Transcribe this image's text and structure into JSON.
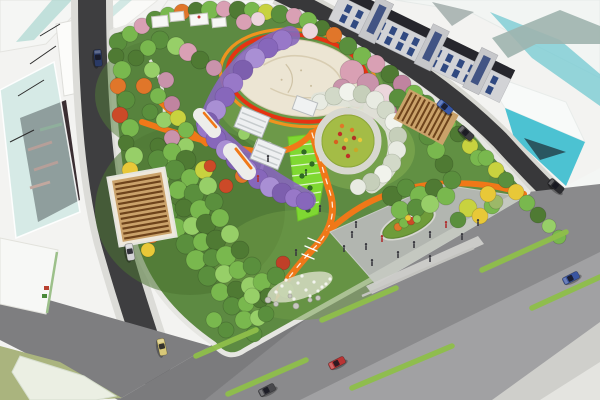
{
  "description": "Aerial perspective rendering of an urban pocket-park masterplan with surrounding streets and schematic buildings",
  "palette": {
    "bg": "#f3f3f1",
    "road_dark": "#3e3e40",
    "road_top": "#38383a",
    "sidewalk": "#dcdcd8",
    "boulevard": "#8a8a8c",
    "cross_road": "#7e7e80",
    "park_green": "#5d8a42",
    "lawn_bright": "#7fd832",
    "path_orange": "#f07818",
    "ring_red": "#e63312",
    "ring_orange": "#f7941d",
    "plaza_cream": "#ece5d3",
    "plaza_gray": "#b2b6b0",
    "wisteria": "#9878c8",
    "glass_teal": "#4cc2d2",
    "glass_white": "#f8faf9",
    "window_blue": "#1e3a78",
    "pergola_wood": "#caa26a",
    "pergola_slat": "#6e441c",
    "olive_plot": "#aab47e",
    "stripe_green": "#8fbf4a",
    "curb_white": "#e6e6e2"
  },
  "scene": {
    "trees": [
      [
        118,
        42,
        9,
        "#5a8f3d"
      ],
      [
        130,
        34,
        8,
        "#79b84e"
      ],
      [
        142,
        26,
        8,
        "#d9a0b4"
      ],
      [
        155,
        20,
        9,
        "#5a8f3d"
      ],
      [
        168,
        15,
        8,
        "#79b84e"
      ],
      [
        182,
        12,
        8,
        "#e0762a"
      ],
      [
        196,
        10,
        8,
        "#4f7a33"
      ],
      [
        210,
        10,
        9,
        "#79b84e"
      ],
      [
        224,
        9,
        8,
        "#d9a0b4"
      ],
      [
        238,
        10,
        9,
        "#4f7a33"
      ],
      [
        252,
        10,
        8,
        "#79b84e"
      ],
      [
        266,
        12,
        8,
        "#c8d23f"
      ],
      [
        280,
        14,
        9,
        "#5a8f3d"
      ],
      [
        294,
        16,
        8,
        "#d9a0b4"
      ],
      [
        308,
        21,
        9,
        "#79b84e"
      ],
      [
        322,
        28,
        8,
        "#4f7a33"
      ],
      [
        334,
        35,
        8,
        "#e0762a"
      ],
      [
        310,
        31,
        8,
        "#ecd6dc"
      ],
      [
        244,
        22,
        8,
        "#d9a0b4"
      ],
      [
        258,
        19,
        7,
        "#ecd6dc"
      ],
      [
        348,
        46,
        9,
        "#5a8f3d"
      ],
      [
        362,
        56,
        9,
        "#79b84e"
      ],
      [
        376,
        64,
        9,
        "#d9a0b4"
      ],
      [
        390,
        74,
        9,
        "#4f7a33"
      ],
      [
        402,
        84,
        9,
        "#c084a0"
      ],
      [
        414,
        94,
        9,
        "#79b84e"
      ],
      [
        426,
        104,
        9,
        "#5a8f3d"
      ],
      [
        438,
        114,
        8,
        "#97cf68"
      ],
      [
        448,
        124,
        8,
        "#79b84e"
      ],
      [
        458,
        134,
        8,
        "#4f7a33"
      ],
      [
        470,
        146,
        8,
        "#c8d23f"
      ],
      [
        478,
        158,
        8,
        "#79b84e"
      ],
      [
        352,
        72,
        12,
        "#d9a0b4"
      ],
      [
        368,
        84,
        11,
        "#c993ab"
      ],
      [
        384,
        95,
        11,
        "#ecd6dc"
      ],
      [
        357,
        97,
        10,
        "#c084a0"
      ],
      [
        373,
        109,
        10,
        "#d9a0b4"
      ],
      [
        342,
        88,
        9,
        "#c993ab"
      ],
      [
        388,
        112,
        9,
        "#c084a0"
      ],
      [
        160,
        40,
        9,
        "#5a8f3d"
      ],
      [
        148,
        48,
        8,
        "#79b84e"
      ],
      [
        136,
        58,
        8,
        "#4f7a33"
      ],
      [
        152,
        70,
        8,
        "#97cf68"
      ],
      [
        166,
        80,
        8,
        "#c993ab"
      ],
      [
        144,
        86,
        8,
        "#e0762a"
      ],
      [
        158,
        96,
        8,
        "#79b84e"
      ],
      [
        172,
        104,
        8,
        "#c084a0"
      ],
      [
        150,
        112,
        8,
        "#5a8f3d"
      ],
      [
        164,
        120,
        8,
        "#97cf68"
      ],
      [
        178,
        118,
        8,
        "#c8d23f"
      ],
      [
        186,
        130,
        8,
        "#79b84e"
      ],
      [
        172,
        138,
        8,
        "#c993ab"
      ],
      [
        158,
        146,
        8,
        "#4f7a33"
      ],
      [
        186,
        146,
        8,
        "#97cf68"
      ],
      [
        174,
        158,
        9,
        "#79b84e"
      ],
      [
        176,
        46,
        9,
        "#97cf68"
      ],
      [
        188,
        52,
        9,
        "#d9a0b4"
      ],
      [
        200,
        60,
        9,
        "#4f7a33"
      ],
      [
        214,
        68,
        8,
        "#c993ab"
      ],
      [
        116,
        56,
        8,
        "#4f7a33"
      ],
      [
        122,
        70,
        9,
        "#79b84e"
      ],
      [
        118,
        86,
        8,
        "#e0762a"
      ],
      [
        126,
        100,
        9,
        "#5a8f3d"
      ],
      [
        120,
        115,
        8,
        "#cc4a28"
      ],
      [
        130,
        128,
        9,
        "#79b84e"
      ],
      [
        126,
        143,
        8,
        "#4f7a33"
      ],
      [
        134,
        156,
        9,
        "#97cf68"
      ],
      [
        130,
        170,
        8,
        "#e8c838"
      ],
      [
        138,
        184,
        8,
        "#5a8f3d"
      ],
      [
        134,
        198,
        8,
        "#79b84e"
      ],
      [
        142,
        212,
        8,
        "#4f7a33"
      ],
      [
        146,
        226,
        8,
        "#97cf68"
      ],
      [
        158,
        160,
        10,
        "#5a8f3d"
      ],
      [
        172,
        152,
        9,
        "#79b84e"
      ],
      [
        186,
        160,
        10,
        "#4f7a33"
      ],
      [
        160,
        178,
        9,
        "#97cf68"
      ],
      [
        175,
        170,
        10,
        "#5a8f3d"
      ],
      [
        190,
        178,
        9,
        "#79b84e"
      ],
      [
        204,
        170,
        9,
        "#c8d23f"
      ],
      [
        162,
        196,
        10,
        "#4f7a33"
      ],
      [
        178,
        190,
        9,
        "#79b84e"
      ],
      [
        194,
        194,
        10,
        "#5a8f3d"
      ],
      [
        208,
        186,
        9,
        "#97cf68"
      ],
      [
        168,
        212,
        10,
        "#5a8f3d"
      ],
      [
        184,
        208,
        9,
        "#4f7a33"
      ],
      [
        200,
        210,
        10,
        "#79b84e"
      ],
      [
        214,
        202,
        9,
        "#5a8f3d"
      ],
      [
        176,
        228,
        10,
        "#79b84e"
      ],
      [
        192,
        226,
        9,
        "#97cf68"
      ],
      [
        206,
        224,
        10,
        "#4f7a33"
      ],
      [
        220,
        218,
        9,
        "#79b84e"
      ],
      [
        186,
        244,
        10,
        "#5a8f3d"
      ],
      [
        202,
        242,
        9,
        "#79b84e"
      ],
      [
        216,
        240,
        10,
        "#4f7a33"
      ],
      [
        230,
        234,
        9,
        "#97cf68"
      ],
      [
        196,
        260,
        10,
        "#79b84e"
      ],
      [
        212,
        258,
        9,
        "#5a8f3d"
      ],
      [
        226,
        256,
        10,
        "#79b84e"
      ],
      [
        240,
        250,
        9,
        "#4f7a33"
      ],
      [
        208,
        276,
        10,
        "#5a8f3d"
      ],
      [
        224,
        274,
        9,
        "#97cf68"
      ],
      [
        238,
        270,
        9,
        "#79b84e"
      ],
      [
        252,
        266,
        9,
        "#5a8f3d"
      ],
      [
        220,
        292,
        9,
        "#79b84e"
      ],
      [
        236,
        290,
        9,
        "#4f7a33"
      ],
      [
        250,
        286,
        9,
        "#97cf68"
      ],
      [
        232,
        306,
        9,
        "#5a8f3d"
      ],
      [
        246,
        304,
        8,
        "#79b84e"
      ],
      [
        260,
        300,
        8,
        "#4f7a33"
      ],
      [
        244,
        320,
        9,
        "#79b84e"
      ],
      [
        258,
        318,
        8,
        "#97cf68"
      ],
      [
        254,
        334,
        8,
        "#5a8f3d"
      ],
      [
        226,
        330,
        8,
        "#5a8f3d"
      ],
      [
        214,
        320,
        8,
        "#79b84e"
      ],
      [
        152,
        236,
        7,
        "#e0762a"
      ],
      [
        226,
        186,
        7,
        "#cc4a28"
      ],
      [
        148,
        250,
        7,
        "#e8c838"
      ],
      [
        242,
        176,
        7,
        "#e0762a"
      ],
      [
        210,
        166,
        6,
        "#cc4a28"
      ],
      [
        283,
        263,
        7,
        "#c04028"
      ],
      [
        262,
        282,
        9,
        "#79b84e"
      ],
      [
        276,
        276,
        9,
        "#5a8f3d"
      ],
      [
        252,
        296,
        8,
        "#97cf68"
      ],
      [
        268,
        296,
        8,
        "#4f7a33"
      ],
      [
        286,
        290,
        8,
        "#79b84e"
      ],
      [
        266,
        314,
        8,
        "#5a8f3d"
      ],
      [
        468,
        208,
        9,
        "#c8d23f"
      ],
      [
        480,
        216,
        8,
        "#e8c838"
      ],
      [
        492,
        206,
        8,
        "#79b84e"
      ],
      [
        496,
        202,
        7,
        "#9cb868"
      ],
      [
        458,
        220,
        8,
        "#5a8f3d"
      ],
      [
        488,
        194,
        8,
        "#e8c838"
      ],
      [
        392,
        196,
        10,
        "#4f7a33"
      ],
      [
        406,
        188,
        9,
        "#5a8f3d"
      ],
      [
        420,
        196,
        10,
        "#79b84e"
      ],
      [
        434,
        188,
        9,
        "#4f7a33"
      ],
      [
        400,
        210,
        9,
        "#79b84e"
      ],
      [
        416,
        208,
        9,
        "#5a8f3d"
      ],
      [
        430,
        204,
        9,
        "#97cf68"
      ],
      [
        446,
        196,
        9,
        "#79b84e"
      ],
      [
        452,
        180,
        9,
        "#5a8f3d"
      ],
      [
        444,
        164,
        9,
        "#4f7a33"
      ],
      [
        436,
        150,
        9,
        "#79b84e"
      ],
      [
        428,
        136,
        9,
        "#5a8f3d"
      ],
      [
        412,
        108,
        9,
        "#4f7a33"
      ],
      [
        398,
        98,
        9,
        "#5a8f3d"
      ],
      [
        256,
        126,
        7,
        "#5a8f3d"
      ],
      [
        244,
        134,
        6,
        "#97cf68"
      ],
      [
        246,
        118,
        7,
        "#79b84e"
      ],
      [
        486,
        158,
        8,
        "#79b84e"
      ],
      [
        496,
        170,
        8,
        "#c8d23f"
      ],
      [
        506,
        180,
        8,
        "#5a8f3d"
      ],
      [
        516,
        192,
        8,
        "#e8c838"
      ],
      [
        527,
        203,
        8,
        "#79b84e"
      ],
      [
        538,
        215,
        8,
        "#4f7a33"
      ],
      [
        549,
        226,
        7,
        "#97cf68"
      ],
      [
        559,
        237,
        7,
        "#79b84e"
      ],
      [
        398,
        227,
        4,
        "#e0762a"
      ],
      [
        404,
        223,
        5,
        "#7ab84a"
      ],
      [
        411,
        221,
        4,
        "#cc4a28"
      ],
      [
        417,
        219,
        4,
        "#8cc95c"
      ],
      [
        408,
        218,
        3,
        "#e8c838"
      ],
      [
        304,
        152,
        2.5,
        "#2e6a24"
      ],
      [
        312,
        164,
        2.5,
        "#2e6a24"
      ],
      [
        302,
        176,
        2.5,
        "#2e6a24"
      ],
      [
        310,
        188,
        2.5,
        "#2e6a24"
      ],
      [
        300,
        200,
        2.5,
        "#2e6a24"
      ],
      [
        308,
        210,
        2.5,
        "#2e6a24"
      ]
    ],
    "wisteria_blobs": [
      [
        282,
        40,
        10
      ],
      [
        268,
        48,
        10
      ],
      [
        255,
        58,
        10
      ],
      [
        243,
        70,
        10
      ],
      [
        233,
        83,
        10
      ],
      [
        225,
        97,
        10
      ],
      [
        216,
        110,
        10
      ],
      [
        208,
        122,
        10
      ],
      [
        207,
        128,
        10
      ],
      [
        216,
        139,
        10
      ],
      [
        226,
        150,
        10
      ],
      [
        236,
        160,
        10
      ],
      [
        247,
        170,
        10
      ],
      [
        258,
        179,
        10
      ],
      [
        270,
        187,
        10
      ],
      [
        282,
        193,
        10
      ],
      [
        294,
        198,
        9
      ],
      [
        305,
        201,
        9
      ]
    ],
    "trellis_blobs": [
      [
        320,
        102,
        8
      ],
      [
        334,
        96,
        9
      ],
      [
        348,
        92,
        9
      ],
      [
        362,
        94,
        9
      ],
      [
        375,
        100,
        9
      ],
      [
        386,
        110,
        9
      ],
      [
        394,
        122,
        9
      ],
      [
        398,
        136,
        9
      ],
      [
        397,
        150,
        9
      ],
      [
        392,
        163,
        9
      ],
      [
        383,
        174,
        9
      ],
      [
        371,
        182,
        9
      ],
      [
        358,
        187,
        8
      ]
    ],
    "garden_flowers": [
      [
        340,
        134,
        "#c03028"
      ],
      [
        352,
        130,
        "#e07828"
      ],
      [
        360,
        140,
        "#e8c838"
      ],
      [
        344,
        148,
        "#b03226"
      ],
      [
        336,
        142,
        "#d86020"
      ],
      [
        356,
        150,
        "#c8a828"
      ],
      [
        348,
        156,
        "#c03028"
      ],
      [
        342,
        126,
        "#e07828"
      ],
      [
        354,
        138,
        "#b03226"
      ],
      [
        346,
        140,
        "#e8c838"
      ]
    ],
    "white_flower_dots": [
      [
        282,
        286
      ],
      [
        290,
        292
      ],
      [
        298,
        283
      ],
      [
        306,
        290
      ],
      [
        314,
        282
      ],
      [
        322,
        287
      ],
      [
        330,
        279
      ],
      [
        276,
        292
      ],
      [
        294,
        299
      ],
      [
        310,
        296
      ],
      [
        318,
        291
      ],
      [
        286,
        280
      ],
      [
        302,
        276
      ],
      [
        326,
        284
      ]
    ],
    "rocks": [
      [
        268,
        300,
        3
      ],
      [
        276,
        304,
        2.5
      ],
      [
        296,
        306,
        3
      ],
      [
        318,
        298,
        2.5
      ],
      [
        290,
        296,
        2
      ],
      [
        310,
        300,
        2.2
      ]
    ],
    "people": [
      [
        352,
        238,
        "#3a3a40"
      ],
      [
        366,
        250,
        "#3a3a40"
      ],
      [
        382,
        242,
        "#b03030"
      ],
      [
        398,
        258,
        "#3a3a40"
      ],
      [
        414,
        248,
        "#3a3a40"
      ],
      [
        430,
        238,
        "#3a3a40"
      ],
      [
        446,
        228,
        "#b03030"
      ],
      [
        372,
        266,
        "#3a3a40"
      ],
      [
        344,
        252,
        "#3a3a40"
      ],
      [
        462,
        240,
        "#3a3a40"
      ],
      [
        478,
        226,
        "#3a3a40"
      ],
      [
        430,
        262,
        "#3a3a40"
      ],
      [
        356,
        228,
        "#3a3a40"
      ],
      [
        320,
        212,
        "#3a3a40"
      ],
      [
        296,
        256,
        "#3a3a40"
      ],
      [
        268,
        162,
        "#3a3a40"
      ],
      [
        258,
        182,
        "#b03030"
      ],
      [
        306,
        176,
        "#2e5a28"
      ]
    ],
    "cars": [
      [
        130,
        252,
        80,
        "#d4d4d6"
      ],
      [
        162,
        347,
        78,
        "#d8c878"
      ],
      [
        98,
        58,
        85,
        "#2a3a66"
      ],
      [
        337,
        363,
        -27,
        "#b93434"
      ],
      [
        267,
        390,
        -27,
        "#48484c"
      ],
      [
        571,
        278,
        -27,
        "#3a55a0"
      ],
      [
        556,
        186,
        40,
        "#2c2c30"
      ],
      [
        445,
        107,
        40,
        "#3858a8"
      ],
      [
        466,
        133,
        42,
        "#3c3c40"
      ]
    ],
    "lane_stripes": [
      [
        482,
        270,
        566,
        232
      ],
      [
        322,
        320,
        396,
        288
      ],
      [
        228,
        394,
        306,
        360
      ],
      [
        352,
        388,
        452,
        346
      ],
      [
        532,
        308,
        600,
        277
      ],
      [
        196,
        356,
        256,
        330
      ]
    ],
    "building_windows": {
      "rows": 2,
      "cols": 14,
      "x0": 10,
      "y0": 4,
      "w": 6,
      "h": 8,
      "dx": 12.5,
      "dy": 11
    }
  }
}
